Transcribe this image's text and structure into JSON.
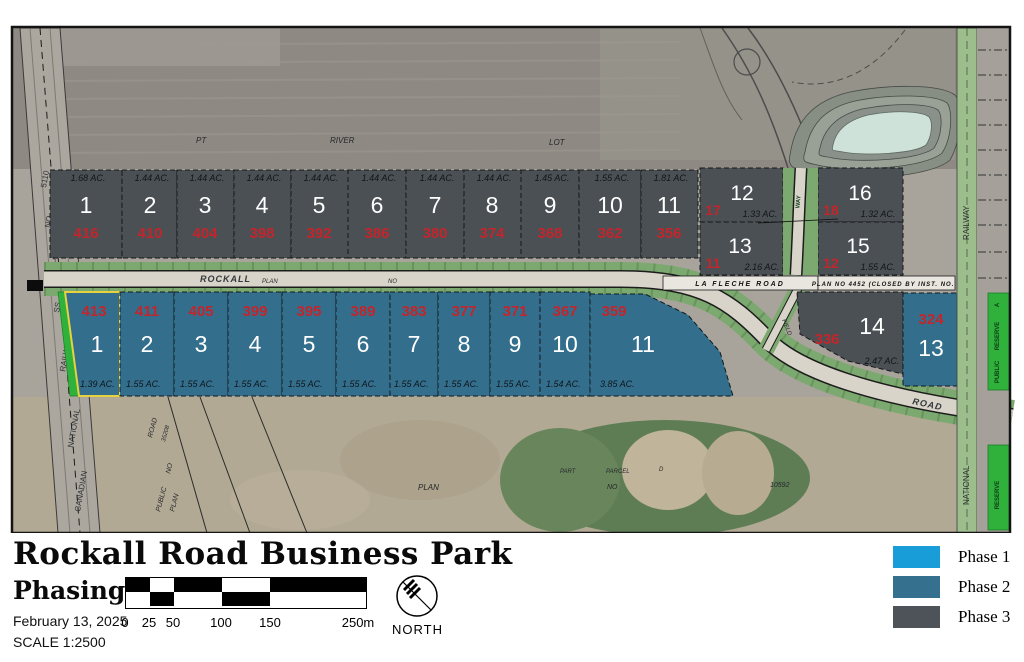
{
  "map": {
    "top_lots": [
      {
        "num": "1",
        "red": "416",
        "acreage": "1.68 AC."
      },
      {
        "num": "2",
        "red": "410",
        "acreage": "1.44 AC."
      },
      {
        "num": "3",
        "red": "404",
        "acreage": "1.44 AC."
      },
      {
        "num": "4",
        "red": "398",
        "acreage": "1.44 AC."
      },
      {
        "num": "5",
        "red": "392",
        "acreage": "1.44 AC."
      },
      {
        "num": "6",
        "red": "386",
        "acreage": "1.44 AC."
      },
      {
        "num": "7",
        "red": "380",
        "acreage": "1.44 AC."
      },
      {
        "num": "8",
        "red": "374",
        "acreage": "1.44 AC."
      },
      {
        "num": "9",
        "red": "368",
        "acreage": "1.45 AC."
      },
      {
        "num": "10",
        "red": "362",
        "acreage": "1.55 AC."
      },
      {
        "num": "11",
        "red": "356",
        "acreage": "1.81 AC."
      }
    ],
    "east_lots": [
      {
        "num": "12",
        "red": "17",
        "acreage": "1.33 AC."
      },
      {
        "num": "13",
        "red": "11",
        "acreage": "2.16 AC."
      },
      {
        "num": "16",
        "red": "18",
        "acreage": "1.32 AC."
      },
      {
        "num": "15",
        "red": "12",
        "acreage": "1.55 AC."
      }
    ],
    "south_lots": [
      {
        "num": "1",
        "red": "413",
        "acreage": "1.39 AC."
      },
      {
        "num": "2",
        "red": "411",
        "acreage": "1.55 AC."
      },
      {
        "num": "3",
        "red": "405",
        "acreage": "1.55 AC."
      },
      {
        "num": "4",
        "red": "399",
        "acreage": "1.55 AC."
      },
      {
        "num": "5",
        "red": "395",
        "acreage": "1.55 AC."
      },
      {
        "num": "6",
        "red": "389",
        "acreage": "1.55 AC."
      },
      {
        "num": "7",
        "red": "383",
        "acreage": "1.55 AC."
      },
      {
        "num": "8",
        "red": "377",
        "acreage": "1.55 AC."
      },
      {
        "num": "9",
        "red": "371",
        "acreage": "1.55 AC."
      },
      {
        "num": "10",
        "red": "367",
        "acreage": "1.54 AC."
      },
      {
        "num": "11",
        "red": "359",
        "acreage": "3.85 AC."
      }
    ],
    "far_lots": [
      {
        "num": "14",
        "red": "336",
        "acreage": "2.47 AC."
      },
      {
        "num": "13",
        "red": "324"
      }
    ],
    "roads": {
      "rockall": "ROCKALL",
      "plan": "PLAN",
      "no": "NO",
      "la_fleche": "LA  FLECHE  ROAD",
      "plan4452": "PLAN NO 4452 (CLOSED BY INST. NO.          )",
      "way": "WAY",
      "field": "FIELD",
      "road_curve": "ROAD"
    },
    "railway_west": [
      "5110",
      "NO",
      "PLAN",
      "SS",
      "RAILWAY",
      "NATIONAL",
      "CANADIAN"
    ],
    "railway_east": {
      "railway": "RAILWAY",
      "national": "NATIONAL"
    },
    "reserves": {
      "a": "A",
      "reserve": "RESERVE",
      "public": "PUBLIC",
      "reserve2": "RESERVE"
    },
    "bg_labels": {
      "pt": "PT",
      "river": "RIVER",
      "lot": "LOT",
      "plan": "PLAN",
      "part": "PART",
      "parcel": "PARCEL",
      "d": "D",
      "no": "NO",
      "num10592": "10592",
      "road": "ROAD",
      "road_no": "35208",
      "no2": "NO",
      "public": "PUBLIC",
      "plan2": "PLAN"
    }
  },
  "footer": {
    "title": "Rockall Road Business Park",
    "subtitle": "Phasing",
    "date": "February 13, 2025",
    "scale": "SCALE 1:2500",
    "scale_ticks": [
      "0",
      "25",
      "50",
      "100",
      "150",
      "250m"
    ],
    "north": "NORTH",
    "legend": [
      {
        "label": "Phase 1",
        "color": "#189dd8"
      },
      {
        "label": "Phase 2",
        "color": "#35708e"
      },
      {
        "label": "Phase 3",
        "color": "#4d5358"
      }
    ]
  }
}
